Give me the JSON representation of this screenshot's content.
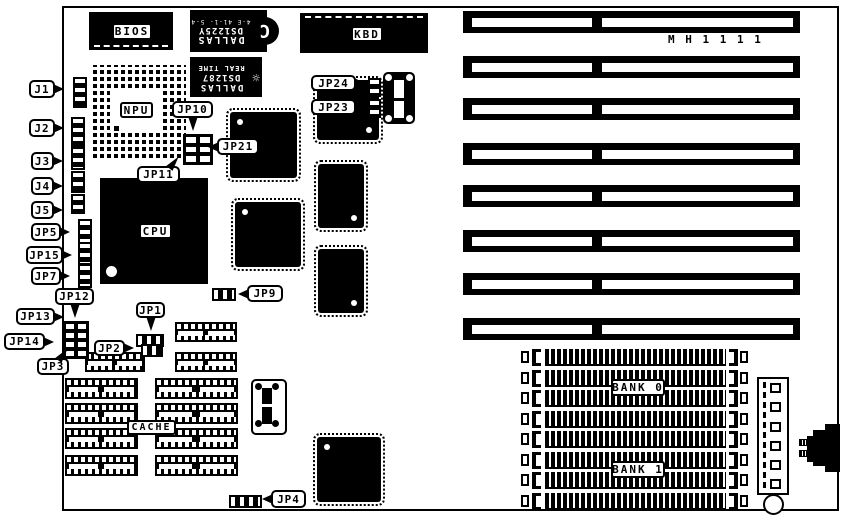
{
  "board": {
    "model": "M H 1 1 1 1"
  },
  "chips": {
    "bios": "BIOS",
    "kbd": "KBD",
    "npu": "NPU",
    "cpu": "CPU",
    "cache": "CACHE",
    "bank0": "BANK 0",
    "bank1": "BANK 1",
    "nvram": {
      "brand": "DALLAS",
      "part": "DS1225Y",
      "code": "4-E 41-1- 5-4",
      "logo": "C"
    },
    "rtc": {
      "brand": "DALLAS",
      "part": "DS1287",
      "line": "REAL TIME",
      "icon": "☼"
    }
  },
  "jumpers": {
    "j1": "J1",
    "j2": "J2",
    "j3": "J3",
    "j4": "J4",
    "j5": "J5",
    "jp1": "JP1",
    "jp2": "JP2",
    "jp3": "JP3",
    "jp4": "JP4",
    "jp5": "JP5",
    "jp7": "JP7",
    "jp9": "JP9",
    "jp10": "JP10",
    "jp11": "JP11",
    "jp12": "JP12",
    "jp13": "JP13",
    "jp14": "JP14",
    "jp15": "JP15",
    "jp21": "JP21",
    "jp23": "JP23",
    "jp24": "JP24"
  },
  "geometry": {
    "isa": {
      "x": 463,
      "w": 337,
      "h": 22,
      "innerY": 7,
      "innerH": 9,
      "inner": [
        {
          "x": 9,
          "w": 120
        },
        {
          "x": 139,
          "w": 191
        }
      ],
      "ys": [
        11,
        56,
        98,
        143,
        185,
        230,
        273,
        318
      ]
    },
    "simms": {
      "x": 521,
      "ys": [
        349,
        370,
        390,
        411,
        431,
        452,
        472,
        493
      ]
    },
    "dips": [
      [
        175,
        322,
        62,
        20
      ],
      [
        175,
        352,
        62,
        20
      ],
      [
        85,
        352,
        60,
        20
      ],
      [
        65,
        378,
        73,
        21
      ],
      [
        155,
        378,
        83,
        21
      ],
      [
        65,
        403,
        73,
        21
      ],
      [
        155,
        403,
        83,
        21
      ],
      [
        65,
        428,
        73,
        21
      ],
      [
        155,
        428,
        83,
        21
      ],
      [
        65,
        455,
        73,
        21
      ],
      [
        155,
        455,
        83,
        21
      ]
    ],
    "qfps": [
      [
        230,
        112,
        67,
        66,
        "tl"
      ],
      [
        235,
        202,
        66,
        65,
        "tl"
      ],
      [
        317,
        80,
        62,
        60,
        "br"
      ],
      [
        318,
        164,
        46,
        64,
        "br"
      ],
      [
        318,
        249,
        46,
        64,
        "br"
      ],
      [
        317,
        437,
        64,
        65,
        "tl"
      ]
    ],
    "vstrips": [
      [
        73,
        77,
        10,
        27
      ],
      [
        71,
        117,
        10,
        26
      ],
      [
        71,
        147,
        10,
        19
      ],
      [
        71,
        171,
        10,
        18
      ],
      [
        71,
        194,
        10,
        16
      ],
      [
        78,
        219,
        10,
        21
      ],
      [
        78,
        242,
        10,
        19
      ],
      [
        78,
        264,
        10,
        20
      ],
      [
        368,
        78,
        9,
        15
      ],
      [
        368,
        99,
        9,
        15
      ]
    ],
    "hstrips": [
      [
        136,
        334,
        24,
        9
      ],
      [
        141,
        344,
        18,
        9
      ],
      [
        212,
        288,
        20,
        9
      ],
      [
        229,
        495,
        29,
        9
      ]
    ],
    "grids": [
      [
        63,
        321,
        22,
        34,
        2,
        4
      ],
      [
        183,
        134,
        26,
        27,
        2,
        3
      ]
    ],
    "pwr_squares_y": [
      383,
      402,
      422,
      441,
      460,
      479
    ]
  }
}
